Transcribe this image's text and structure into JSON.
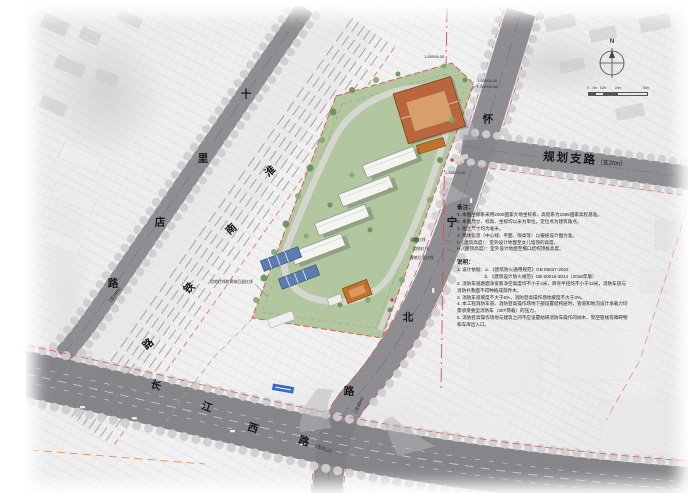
{
  "map": {
    "north_label": "N",
    "scalebar": {
      "ticks": [
        "0",
        "5m",
        "10m",
        "20m",
        "50m"
      ]
    },
    "roads": {
      "planned_branch": {
        "name": "规划支路",
        "spec": "（支20m）"
      },
      "shilidian": {
        "chars": [
          "十",
          "里",
          "店",
          "路"
        ],
        "spec": "（支24m）"
      },
      "railway": {
        "chars": [
          "淮",
          "南",
          "铁",
          "路"
        ]
      },
      "huaining": {
        "chars": [
          "怀",
          "宁",
          "北",
          "路"
        ],
        "spec": "（主40m）"
      },
      "changjiang": {
        "chars": [
          "长",
          "江",
          "西",
          "路"
        ],
        "spec": "（主80m）"
      }
    },
    "markers": {
      "m1": "1-50006.00",
      "m2": "1-50005.40",
      "m3": "F-50004.08",
      "m4": "1-50003.00"
    },
    "leaders": {
      "right": [
        "道路红线",
        "用地红线",
        "建筑后退红线"
      ],
      "left": "用地红线和建筑后退红线"
    }
  },
  "notes": {
    "title": "备注：",
    "items": [
      "1. 本图坐标系采用2000国家大地坐标系，高程系为1985国家高程基准。",
      "2. 本图尺寸、标高、坐标均以米为单位，定位点为建筑角点。",
      "3. 图上尺寸均为毫米。",
      "4. 单体信息（中心线、平面、限高等）以报规设计图为准。",
      "h（建筑高度）：室外设计地面至女儿墙顶的高度。",
      "H（屋顶高度）：室外设计地面至檐口结构顶板高度。"
    ]
  },
  "instructions": {
    "title": "说明：",
    "items": [
      "1. 设计依据：a. 《建筑防火通用规范》GB 55037-2022",
      "　　　　　　b. 《建筑设计防火规范》GB 50016-2014（2018年版）",
      "2. 消防车道路面净宽和净空高度均不小于4米，转弯半径均不小于12米，消防车道与消防扑救面不得种植成荫乔木。",
      "3. 消防车道坡度不大于8%，消防登高操作场地坡度不大于3%。",
      "4. 本工程消防车道、消防登高操作场地下部设置结构层时，管道和地沟设计承载力均需承受重型消防车（30T荷载）的压力。",
      "5. 消防登高操作场地与建筑之间不应设置妨碍消防车操作的树木、架空管线等障碍物和车库出入口。"
    ]
  },
  "colors": {
    "road": "#87878b",
    "road_major": "#7e7e82",
    "rail_band": "#e4e4e6",
    "rail_line": "#98989c",
    "tree_row": "#cfcfcf",
    "site_green": "#aec49b",
    "tree_green": "#668f54",
    "bldg_orange": "#b9663d",
    "bldg_orange2": "#c0712c",
    "bldg_white": "#f4f4f1",
    "bldg_blue": "#5d7db1",
    "red_line": "#d94f4f",
    "green_line": "#7fbf6f",
    "orange_line": "#e08a3c",
    "text_dark": "#17171a"
  }
}
